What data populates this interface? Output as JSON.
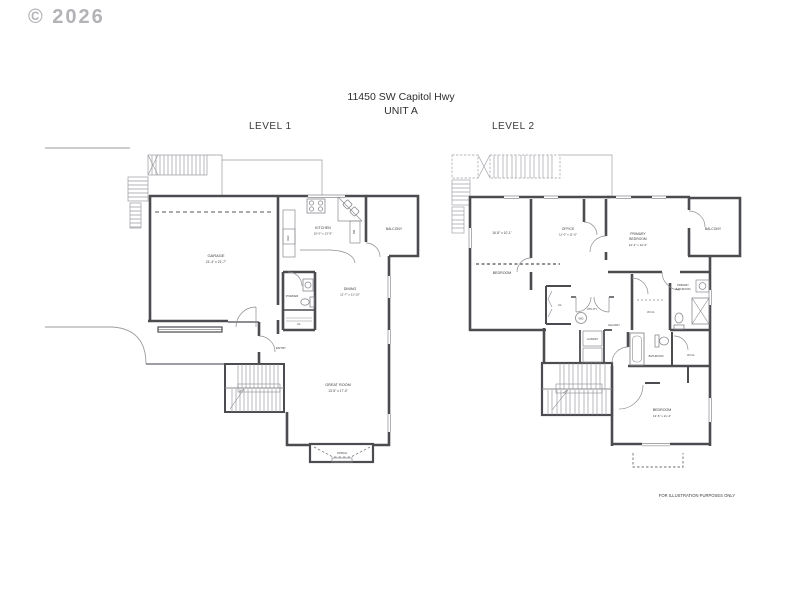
{
  "watermark": "© 2026",
  "title": {
    "address": "11450 SW Capitol Hwy",
    "unit": "UNIT A"
  },
  "level1": {
    "label": "LEVEL 1",
    "rooms": {
      "garage": {
        "name": "GARAGE",
        "dims": "21'-4\" x 21'-7\""
      },
      "kitchen": {
        "name": "KITCHEN",
        "dims": "10'-0\" x 13'-9\""
      },
      "balcony": {
        "name": "BALCONY"
      },
      "dining": {
        "name": "DINING",
        "dims": "11'-7\" x 11'-10\""
      },
      "powder": {
        "name": "POWDER"
      },
      "closet": {
        "name": "CL"
      },
      "entry": {
        "name": "ENTRY"
      },
      "great_room": {
        "name": "GREAT ROOM",
        "dims": "13'-5\" x 17'-0\""
      },
      "porch": {
        "name": "PORCH"
      },
      "ref": {
        "name": "REF"
      },
      "dw": {
        "name": "DW"
      }
    }
  },
  "level2": {
    "label": "LEVEL 2",
    "rooms": {
      "bedroom1": {
        "name": "BEDROOM",
        "dims": "16'-8\" x 10'-1\""
      },
      "office": {
        "name": "OFFICE",
        "dims": "11'-0\" x 11'-0\""
      },
      "primary_bedroom": {
        "name": "PRIMARY",
        "name2": "BEDROOM",
        "dims": "14'-4\" x 12'-2\""
      },
      "balcony": {
        "name": "BALCONY"
      },
      "primary_bathroom": {
        "name": "PRIMARY",
        "name2": "BATHROOM"
      },
      "wicl_primary": {
        "name": "W.I.CL"
      },
      "closet": {
        "name": "CL"
      },
      "utility": {
        "name": "UTILITY"
      },
      "wd": {
        "name": "W/D"
      },
      "hallway": {
        "name": "HALLWAY"
      },
      "laundry": {
        "name": "LAUNDRY"
      },
      "bathroom": {
        "name": "BATHROOM"
      },
      "wicl2": {
        "name": "W.I.CL"
      },
      "bedroom2": {
        "name": "BEDROOM",
        "dims": "13'-6\" x 11'-4\""
      }
    }
  },
  "footer": {
    "disclaimer": "FOR ILLUSTRATION PURPOSES ONLY"
  },
  "colors": {
    "wall": "#4b4b50",
    "light": "#9b9ba1",
    "text": "#3d3d3d"
  }
}
